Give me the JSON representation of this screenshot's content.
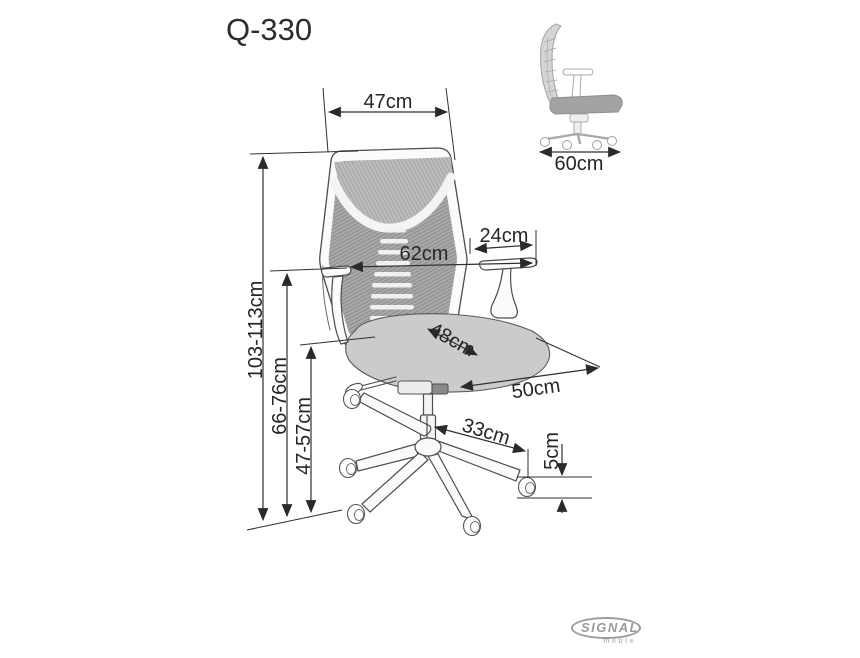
{
  "title": "Q-330",
  "views": {
    "front": {
      "dims": {
        "backrest_width": "47cm",
        "armrest_pad_length": "24cm",
        "armrest_span_width": "62cm",
        "seat_width": "48cm",
        "seat_depth": "50cm",
        "base_leg_reach": "33cm",
        "caster_height": "5cm",
        "total_height": "103-113cm",
        "armrest_height": "66-76cm",
        "seat_height": "47-57cm"
      }
    },
    "side": {
      "dims": {
        "overall_depth": "60cm"
      }
    }
  },
  "logo": {
    "brand": "SIGNAL",
    "subtitle": "meble"
  },
  "colors": {
    "dimension_line": "#2f2f2f",
    "frame_line": "#4d4d4d",
    "mesh_gray": "#a8a8a8",
    "seat_gray": "#cdcdcd",
    "side_view_gray": "#b0b0b0",
    "logo_gray": "#9a9a9a",
    "background": "#ffffff"
  }
}
